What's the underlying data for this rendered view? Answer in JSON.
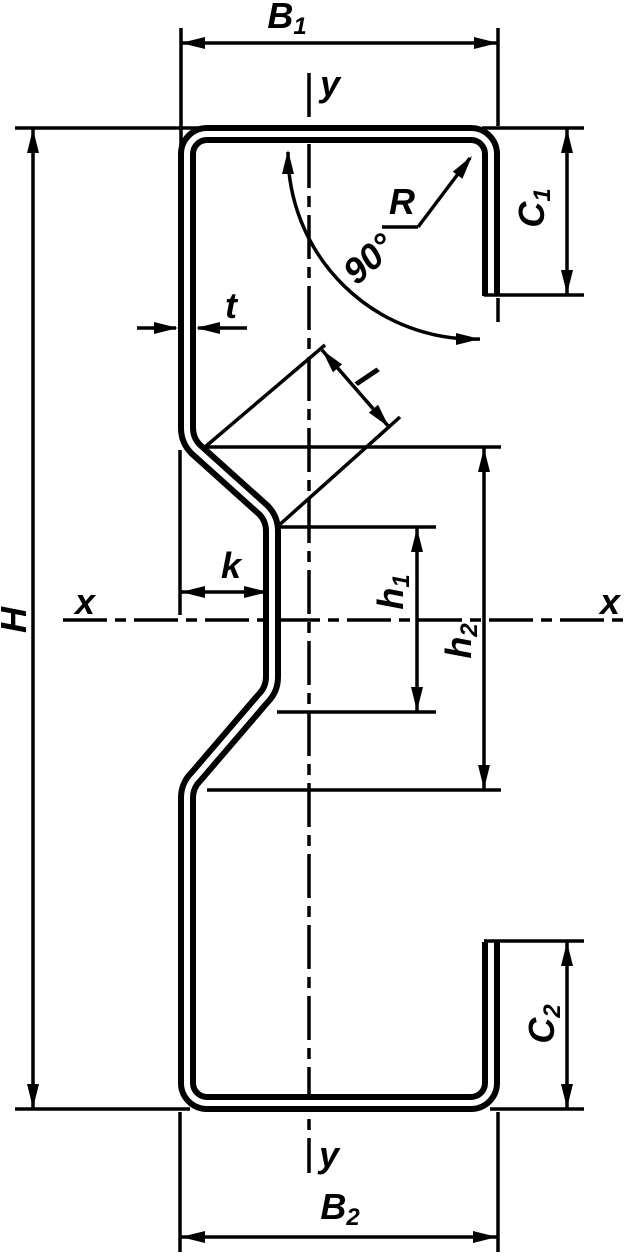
{
  "labels": {
    "b1": {
      "base": "B",
      "sub": "1"
    },
    "b2": {
      "base": "B",
      "sub": "2"
    },
    "c1": {
      "base": "C",
      "sub": "1"
    },
    "c2": {
      "base": "C",
      "sub": "2"
    },
    "h_total": "H",
    "h1": {
      "base": "h",
      "sub": "1"
    },
    "h2": {
      "base": "h",
      "sub": "2"
    },
    "k": "k",
    "t": "t",
    "l": "l",
    "r": "R",
    "angle": "90°",
    "axis_x_left": "x",
    "axis_x_right": "x",
    "axis_y_top": "y",
    "axis_y_bottom": "y"
  },
  "colors": {
    "line": "#000000",
    "background": "#ffffff"
  }
}
